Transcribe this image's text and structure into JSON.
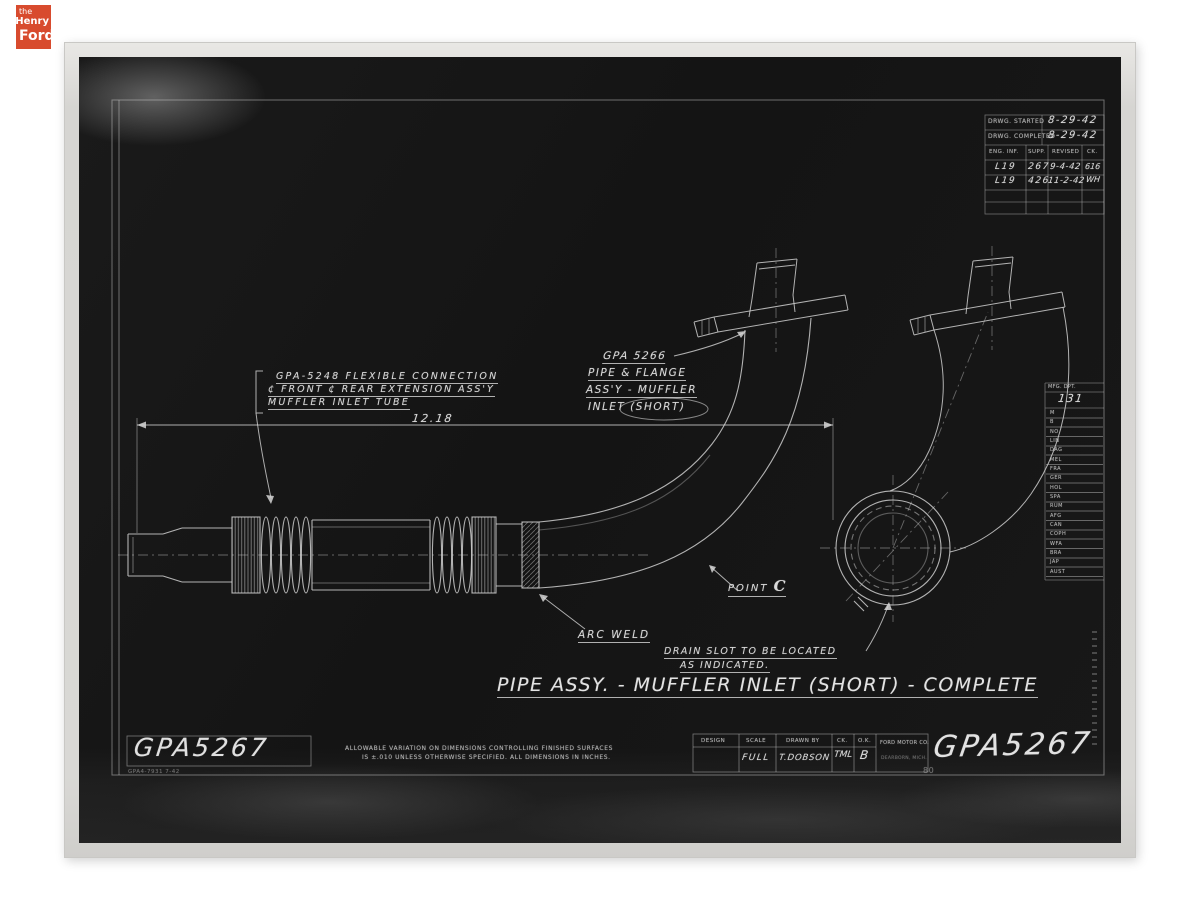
{
  "logo": {
    "the": "the",
    "henry": "Henry",
    "ford": "Ford"
  },
  "revision_table": {
    "drwg_started_label": "DRWG. STARTED",
    "drwg_started_value": "8-29-42",
    "drwg_completed_label": "DRWG. COMPLETED",
    "drwg_completed_value": "8-29-42",
    "headers": [
      "ENG. INF.",
      "SUPP.",
      "REVISED",
      "CK."
    ],
    "rows": [
      {
        "eng_inf": "L19",
        "supp": "267",
        "revised": "9-4-42",
        "ck": "616"
      },
      {
        "eng_inf": "L19",
        "supp": "426",
        "revised": "11-2-42",
        "ck": "WH"
      }
    ]
  },
  "callouts": {
    "flex_connection": {
      "line1": "GPA-5248  FLEXIBLE  CONNECTION",
      "line2": "¢ FRONT ¢ REAR  EXTENSION  ASS'Y",
      "line3": "MUFFLER  INLET  TUBE"
    },
    "overall_dimension": "12.18",
    "pipe_flange": {
      "line1": "GPA 5266",
      "line2": "PIPE & FLANGE",
      "line3": "ASS'Y - MUFFLER",
      "line4": "INLET  (SHORT)"
    },
    "point": {
      "label": "POINT",
      "letter": "C"
    },
    "arc_weld": "ARC WELD",
    "drain_slot": {
      "line1": "DRAIN SLOT TO BE LOCATED",
      "line2": "AS INDICATED."
    },
    "drawing_title": "PIPE ASSY. - MUFFLER INLET (SHORT) - COMPLETE"
  },
  "mfg_table": {
    "header": "MFG. DPT.",
    "department": "131",
    "branch_codes": [
      "M",
      "B",
      "NO",
      "LIN",
      "DAG",
      "MEL",
      "FRA",
      "GER",
      "HOL",
      "SPA",
      "RUM",
      "AFG",
      "CAN",
      "COPH",
      "WFA",
      "BRA",
      "JAP",
      "AUST"
    ]
  },
  "title_block": {
    "headers": [
      "DESIGN",
      "SCALE",
      "DRAWN BY",
      "CK.",
      "O.K."
    ],
    "design": "",
    "scale": "FULL",
    "drawn_by": "T.DOBSON",
    "ck": "TML",
    "ok": "B",
    "company": "FORD MOTOR CO.",
    "company_city": "DEARBORN, MICH."
  },
  "drawing_numbers": {
    "left": "GPA5267",
    "right": "GPA5267"
  },
  "notes": {
    "tolerance_line1": "ALLOWABLE VARIATION ON DIMENSIONS CONTROLLING FINISHED SURFACES",
    "tolerance_line2": "IS ±.010 UNLESS OTHERWISE SPECIFIED.   ALL DIMENSIONS IN INCHES.",
    "form_number": "GPA4-7931   7-42",
    "sheet_stamp": "80"
  },
  "colors": {
    "logo_red": "#d84b2e",
    "ink": "#d9d9d9",
    "paper": "#d7d6d3",
    "film": "#151515"
  }
}
